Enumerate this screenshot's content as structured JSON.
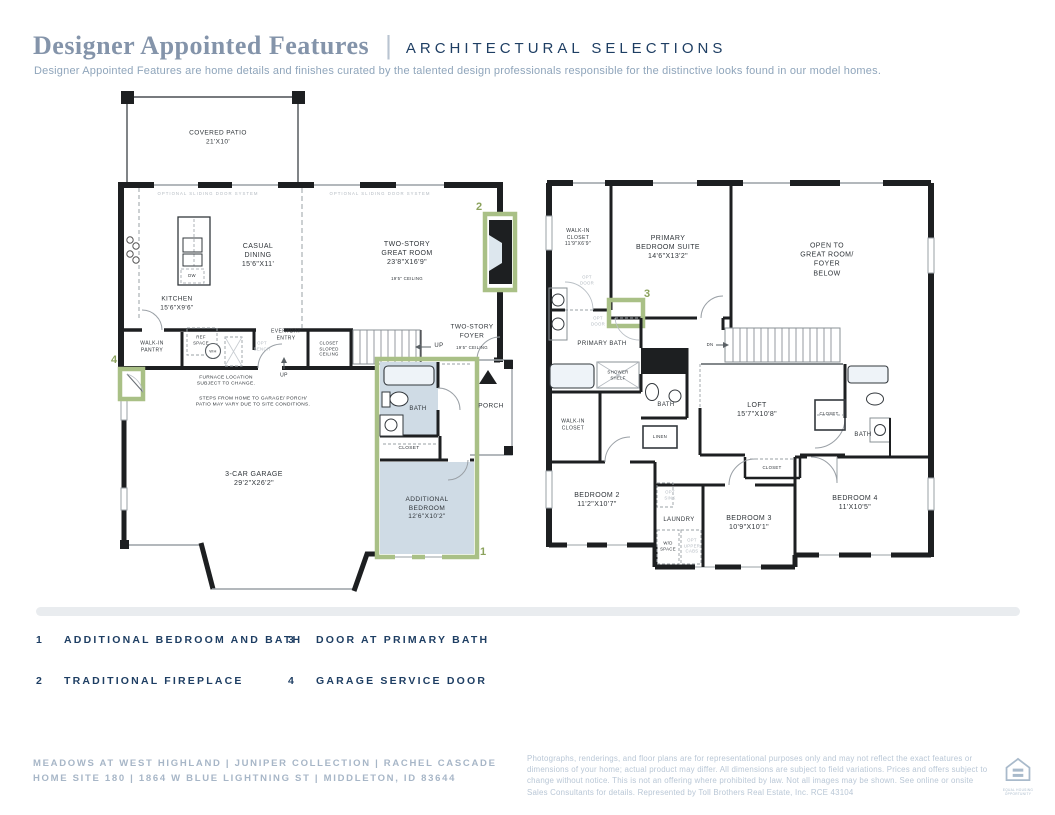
{
  "header": {
    "title": "Designer Appointed Features",
    "separator": "|",
    "selections": "ARCHITECTURAL SELECTIONS",
    "description": "Designer Appointed Features are home details and finishes curated by the talented design professionals responsible for the distinctive looks found in our model homes."
  },
  "colors": {
    "accent_navy": "#1e3e63",
    "title_blue": "#8494aa",
    "subtitle_blue": "#8fa5bb",
    "marker_green": "#8ba25c",
    "highlight_green": "#a9c086",
    "room_fill_blue": "#cfdbe5",
    "wall_black": "#1d1f21"
  },
  "floor1": {
    "labels": {
      "covered_patio": "COVERED PATIO\n21'X10'",
      "sliding_door_left": "OPTIONAL SLIDING DOOR SYSTEM",
      "sliding_door_right": "OPTIONAL SLIDING DOOR SYSTEM",
      "casual_dining": "CASUAL\nDINING\n15'6\"X11'",
      "great_room": "TWO-STORY\nGREAT ROOM\n23'8\"X16'9\"",
      "great_room_ceiling": "19'5\" CEILING",
      "kitchen": "KITCHEN\n15'6\"X9'6\"",
      "walk_in_pantry": "WALK-IN\nPANTRY",
      "ref_space": "REF\nSPACE",
      "opt_bench": "OPT\nBENCH",
      "wh": "WH",
      "dw": "DW",
      "everyday_entry": "EVERYDAY\nENTRY",
      "closet_sloped": "CLOSET\nSLOPED\nCEILING",
      "up_stairs": "UP",
      "up_entry": "UP",
      "two_story_foyer": "TWO-STORY\nFOYER",
      "foyer_ceiling": "19'5\" CEILING",
      "furnace_note": "FURNACE LOCATION\nSUBJECT TO CHANGE.",
      "steps_note": "STEPS FROM HOME TO GARAGE/ PORCH/\nPATIO MAY VARY DUE TO SITE CONDITIONS.",
      "garage": "3-CAR GARAGE\n29'2\"X26'2\"",
      "bath": "BATH",
      "closet": "CLOSET",
      "additional_bedroom": "ADDITIONAL\nBEDROOM\n12'6\"X10'2\"",
      "porch": "PORCH"
    }
  },
  "floor2": {
    "labels": {
      "walk_in_closet_primary": "WALK-IN\nCLOSET\n11'9\"X6'9\"",
      "opt_door_top": "OPT\nDOOR",
      "opt_door_bath": "OPT\nDOOR",
      "primary_bedroom": "PRIMARY\nBEDROOM SUITE\n14'6\"X13'2\"",
      "open_to_below": "OPEN TO\nGREAT ROOM/\nFOYER\nBELOW",
      "primary_bath": "PRIMARY BATH",
      "shower_shelf": "SHOWER\nSHELF",
      "bath_hall": "BATH",
      "walk_in_closet2": "WALK-IN\nCLOSET",
      "linen": "LINEN",
      "loft": "LOFT\n15'7\"X10'8\"",
      "closet_right": "CLOSET",
      "bath_right": "BATH",
      "closet_middle": "CLOSET",
      "dn": "DN",
      "bedroom2": "BEDROOM 2\n11'2\"X10'7\"",
      "opt_sink": "OPT\nSINK",
      "laundry": "LAUNDRY",
      "wd_space": "W/D\nSPACE",
      "opt_upper_cabs": "OPT\nUPPER\nCABS",
      "bedroom3": "BEDROOM 3\n10'9\"X10'1\"",
      "bedroom4": "BEDROOM 4\n11'X10'5\""
    }
  },
  "legend": {
    "items": [
      {
        "num": "1",
        "label": "ADDITIONAL BEDROOM AND BATH"
      },
      {
        "num": "2",
        "label": "TRADITIONAL FIREPLACE"
      },
      {
        "num": "3",
        "label": "DOOR AT PRIMARY BATH"
      },
      {
        "num": "4",
        "label": "GARAGE SERVICE DOOR"
      }
    ]
  },
  "footer": {
    "community": "MEADOWS AT WEST HIGHLAND   |   JUNIPER COLLECTION   |   RACHEL CASCADE\nHOME SITE 180   |   1864 W BLUE LIGHTNING ST   |   MIDDLETON, ID 83644",
    "disclaimer": "Photographs, renderings, and floor plans are for representational purposes only and may not reflect the exact features or dimensions of your home; actual product may differ. All dimensions are subject to field variations. Prices and offers subject to change without notice. This is not an offering where prohibited by law. Not all images may be shown. See online or onsite Sales Consultants for details. Represented by Toll Brothers Real Estate, Inc. RCE 43104",
    "equal_housing": "EQUAL HOUSING\nOPPORTUNITY"
  }
}
